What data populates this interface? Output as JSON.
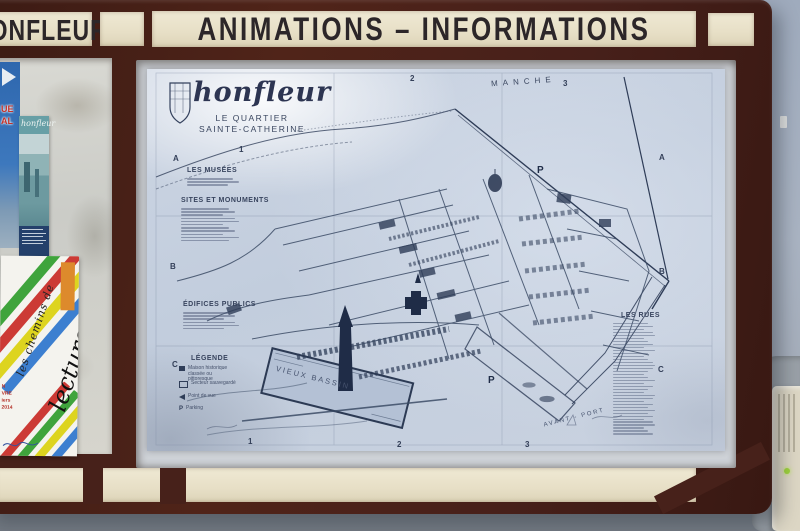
{
  "board": {
    "header": {
      "left_sign_text": "HONFLEUR",
      "main_sign_text": "ANIMATIONS – INFORMATIONS"
    }
  },
  "map": {
    "title": "honfleur",
    "subtitle_line1": "LE QUARTIER",
    "subtitle_line2": "SAINTE-CATHERINE",
    "sea_label": "MANCHE",
    "harbor_label": "VIEUX BASSIN",
    "port_label": "AVANT - PORT",
    "parking_symbol": "P",
    "grid": {
      "columns": [
        "1",
        "2",
        "3"
      ],
      "rows": [
        "A",
        "B",
        "C"
      ]
    },
    "sections": {
      "musees": {
        "heading": "LES MUSÉES",
        "line_count": 3
      },
      "sites": {
        "heading": "SITES ET MONUMENTS",
        "line_count": 11
      },
      "edifices": {
        "heading": "ÉDIFICES PUBLICS",
        "line_count": 6
      },
      "legende": {
        "heading": "LÉGENDE",
        "items": [
          "Maison historique classée ou pittoresque",
          "Secteur sauvegardé",
          "Point de vue",
          "Parking"
        ]
      },
      "rues": {
        "heading": "LES RUES",
        "line_count": 38
      }
    }
  },
  "posters": {
    "blue_poster": {
      "fragments": [
        "UE",
        "AL"
      ]
    },
    "brochure": {
      "title": "honfleur",
      "footer_line_count": 5
    },
    "lecture_poster": {
      "script_text": "les chemins de",
      "main_text": "lecture",
      "red_lines": [
        "N",
        "VRE",
        "iers",
        "2014"
      ]
    }
  },
  "colors": {
    "frame_brown": "#47211a",
    "panel_cream": "#eae3cd",
    "sign_text": "#2c2629",
    "map_paper": "#c9d3e2",
    "map_ink": "#35425e",
    "wall": "#a7b1c1"
  }
}
